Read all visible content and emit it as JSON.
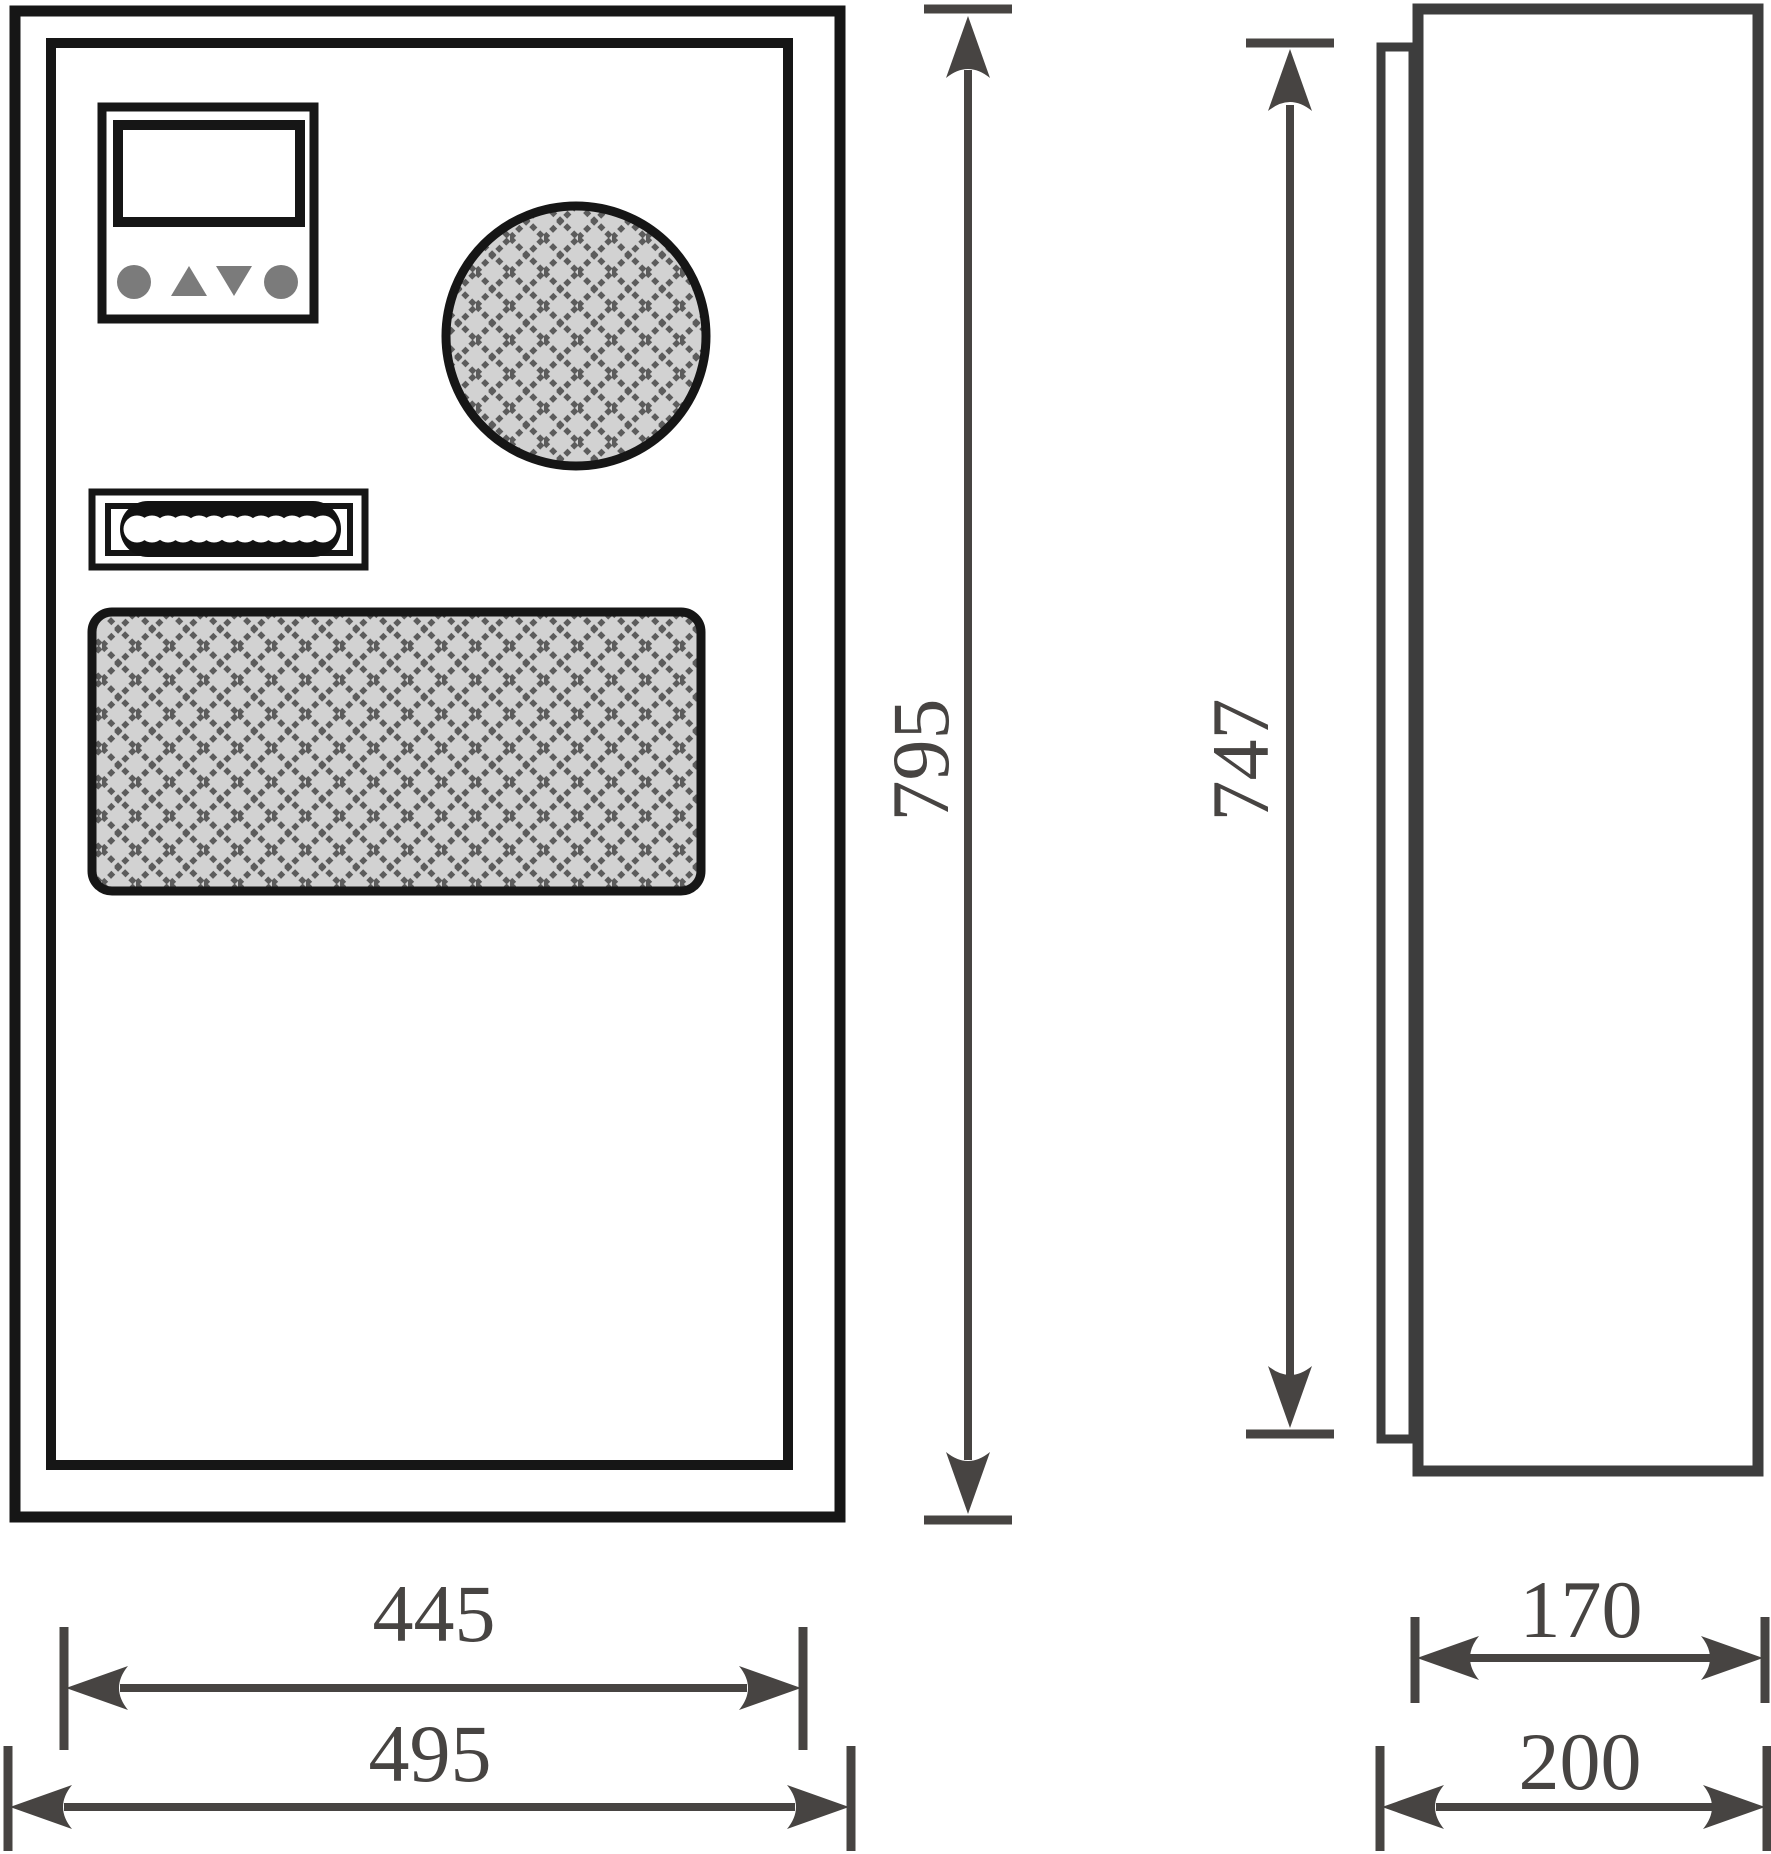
{
  "diagram": {
    "type": "technical-dimension-drawing",
    "subject": "electrical cabinet air-conditioner enclosure, front view and side view"
  },
  "dimensions": {
    "overall_height": "795",
    "door_panel_height": "747",
    "door_width": "445",
    "overall_width": "495",
    "body_depth": "170",
    "overall_depth": "200"
  },
  "icons": {
    "controller_left_button": "circle-button-icon",
    "controller_up_button": "triangle-up-icon",
    "controller_down_button": "triangle-down-icon",
    "controller_right_button": "circle-button-icon",
    "round_vent": "mesh-grille-icon",
    "rect_vent": "mesh-grille-icon",
    "handle": "grip-chain-icon"
  },
  "colors": {
    "outline_black": "#161616",
    "side_view_outline": "#3d3d3d",
    "dimension_gray": "#474442",
    "mesh_fill": "#d2d2d2",
    "mesh_line": "#5c5c5c",
    "button_gray": "#7b7b7b",
    "background": "#ffffff"
  }
}
